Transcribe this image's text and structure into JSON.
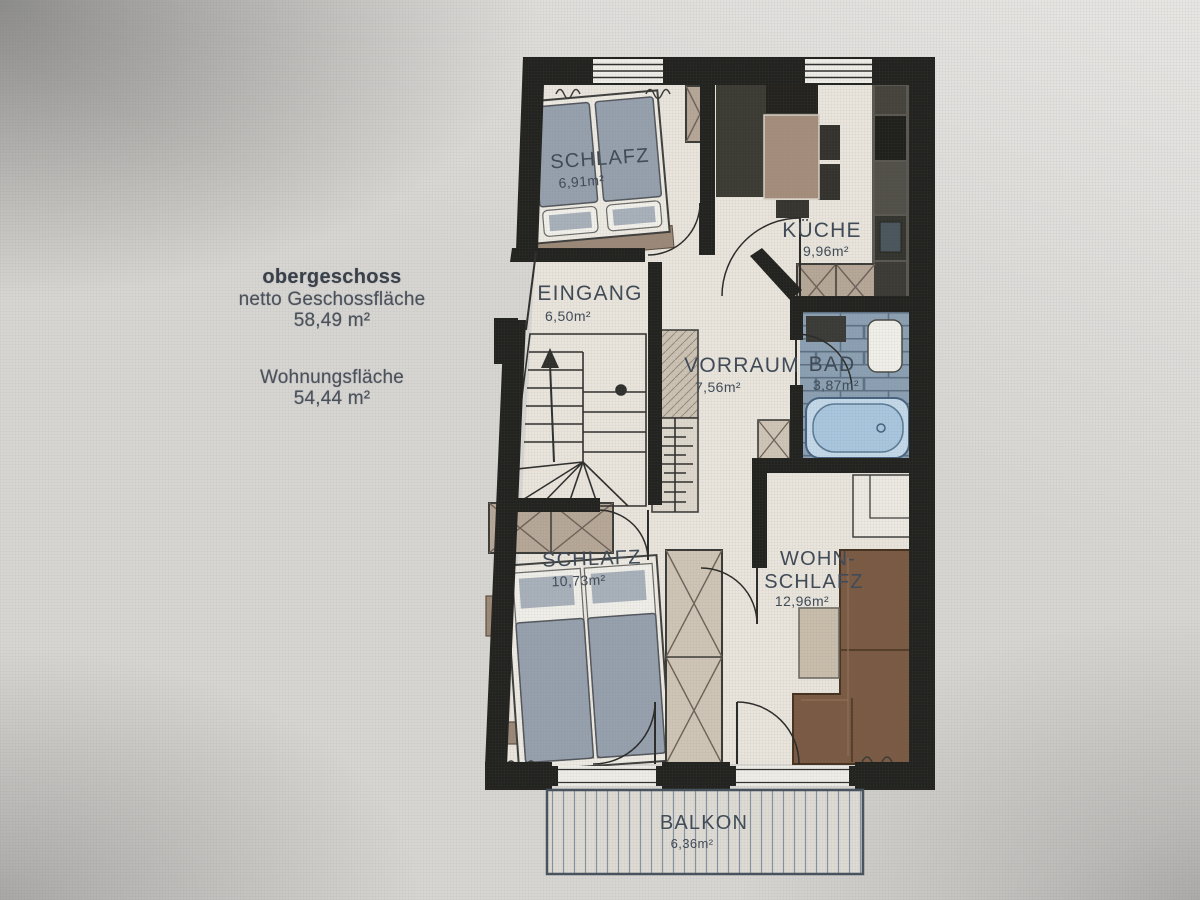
{
  "info_block": {
    "title": "obergeschoss",
    "line1": "netto Geschossfläche",
    "area1": "58,49 m²",
    "line2": "Wohnungsfläche",
    "area2": "54,44 m²"
  },
  "rooms": {
    "schlafz_top": {
      "name": "SCHLAFZ",
      "area": "6,91m²"
    },
    "kueche": {
      "name": "KÜCHE",
      "area": "9,96m²"
    },
    "eingang": {
      "name": "EINGANG",
      "area": "6,50m²"
    },
    "vorraum": {
      "name": "VORRAUM",
      "area": "7,56m²"
    },
    "bad": {
      "name": "BAD",
      "area": "3,87m²"
    },
    "schlafz_lower": {
      "name": "SCHLAFZ",
      "area": "10,73m²"
    },
    "wohn": {
      "line1": "WOHN-",
      "line2": "SCHLAFZ",
      "area": "12,96m²"
    },
    "balkon": {
      "name": "BALKON",
      "area": "6,36m²"
    }
  },
  "palette": {
    "wall": "#22221f",
    "floor": "#e9e5dc",
    "photo_background": "#d8d6d2",
    "label_text": "#3f4a56",
    "wardrobe": "#b6a797",
    "mattress": "#96a1ad",
    "sofa": "#7a5a43",
    "bath_tiles": "#8ba0b2",
    "bathtub": "#b7cfe3",
    "kitchen_block": "#3b3a33",
    "table_wood": "#a58d7b"
  }
}
